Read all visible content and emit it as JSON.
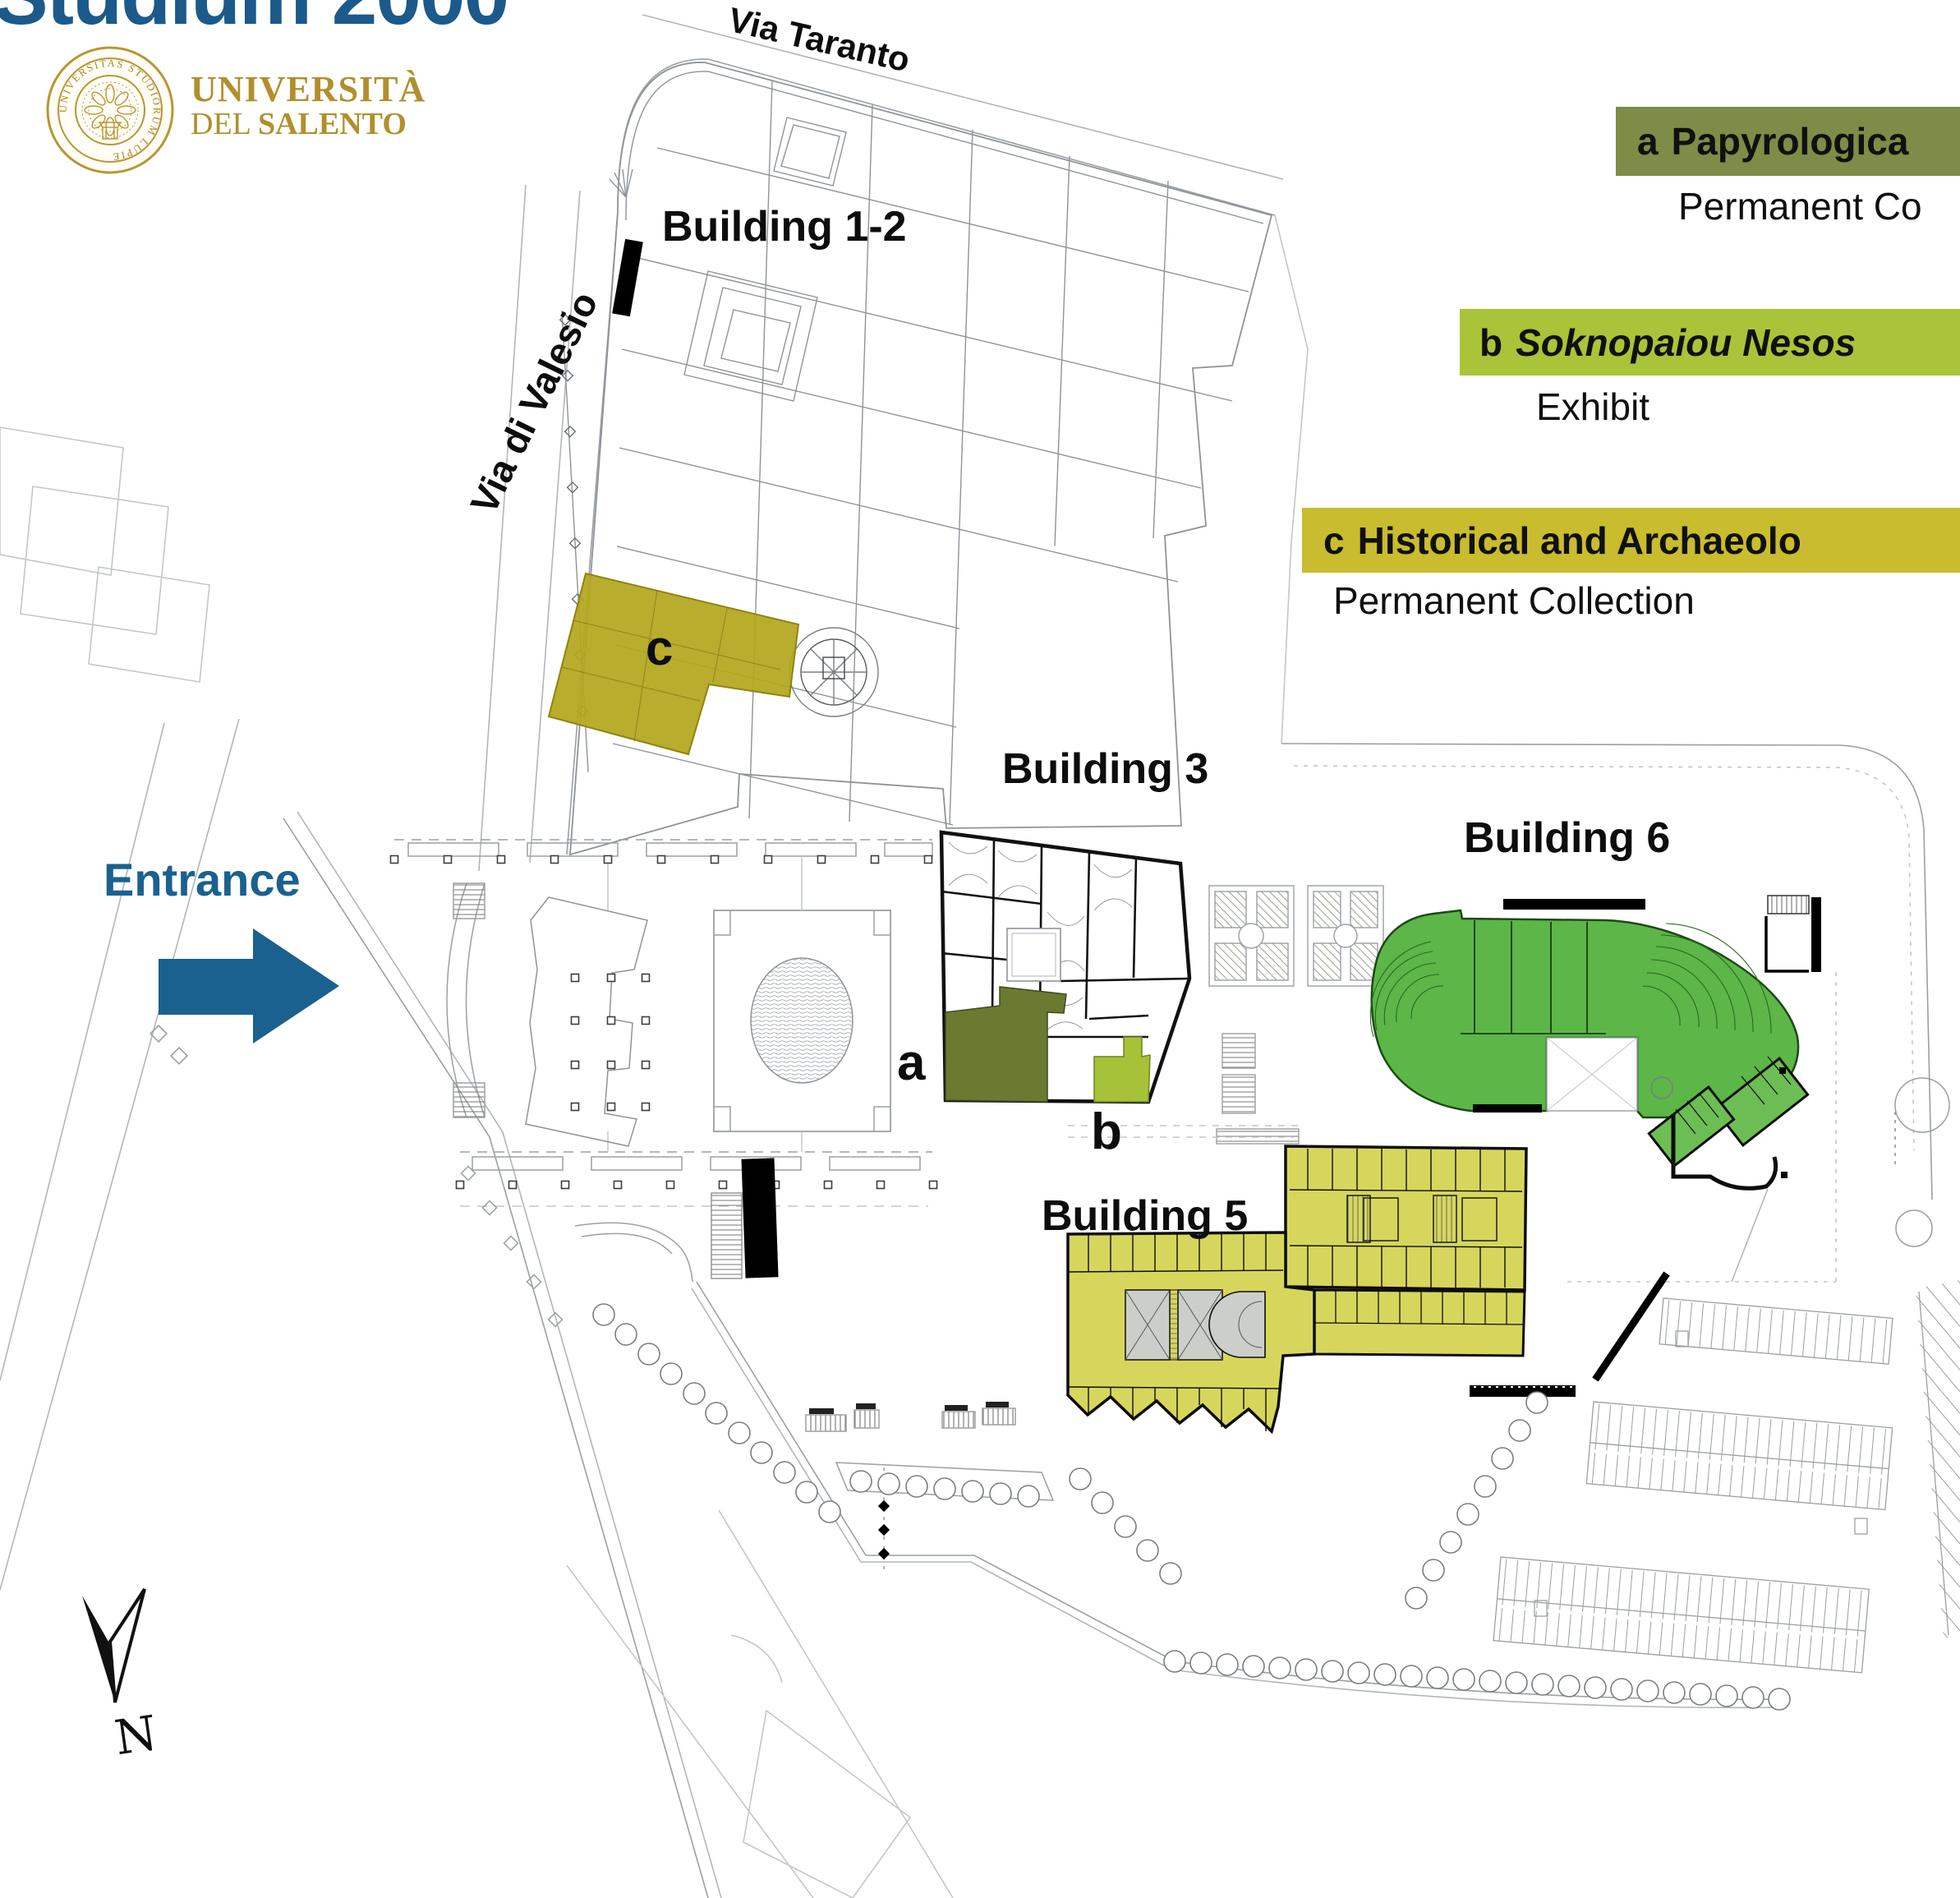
{
  "title": "Studium 2000",
  "logo": {
    "wordmark_line1": "UNIVERSITÀ",
    "wordmark_line2_prefix": "DEL ",
    "wordmark_line2_bold": "SALENTO",
    "seal_ring_text": "UNIVERSITAS STUDIORUM LUPIENSIS"
  },
  "streets": {
    "via_taranto": "Via Taranto",
    "via_di_valesio": "Via di Valesio"
  },
  "buildings": {
    "b12": "Building 1-2",
    "b3": "Building 3",
    "b5": "Building 5",
    "b6": "Building 6"
  },
  "markers": {
    "entrance": "Entrance",
    "north": "N",
    "a": "a",
    "b": "b",
    "c": "c"
  },
  "legend": {
    "a": {
      "key": "a",
      "label": "Papyrologica",
      "sub": "Permanent Co",
      "color": "#7d8c46"
    },
    "b": {
      "key": "b",
      "label": "Soknopaiou Nesos",
      "sub": "Exhibit",
      "color": "#a9c438"
    },
    "c": {
      "key": "c",
      "label": "Historical and Archaeolo",
      "sub": "Permanent Collection",
      "color": "#c9bc2e"
    }
  },
  "colors": {
    "title_blue": "#1b5a8a",
    "entrance_blue": "#1a618f",
    "gold": "#b28f2c",
    "region_a": "#6a7a31",
    "region_b": "#a6c238",
    "region_c": "#b3a71c",
    "building5": "#d7d65c",
    "building6": "#5cb648"
  }
}
